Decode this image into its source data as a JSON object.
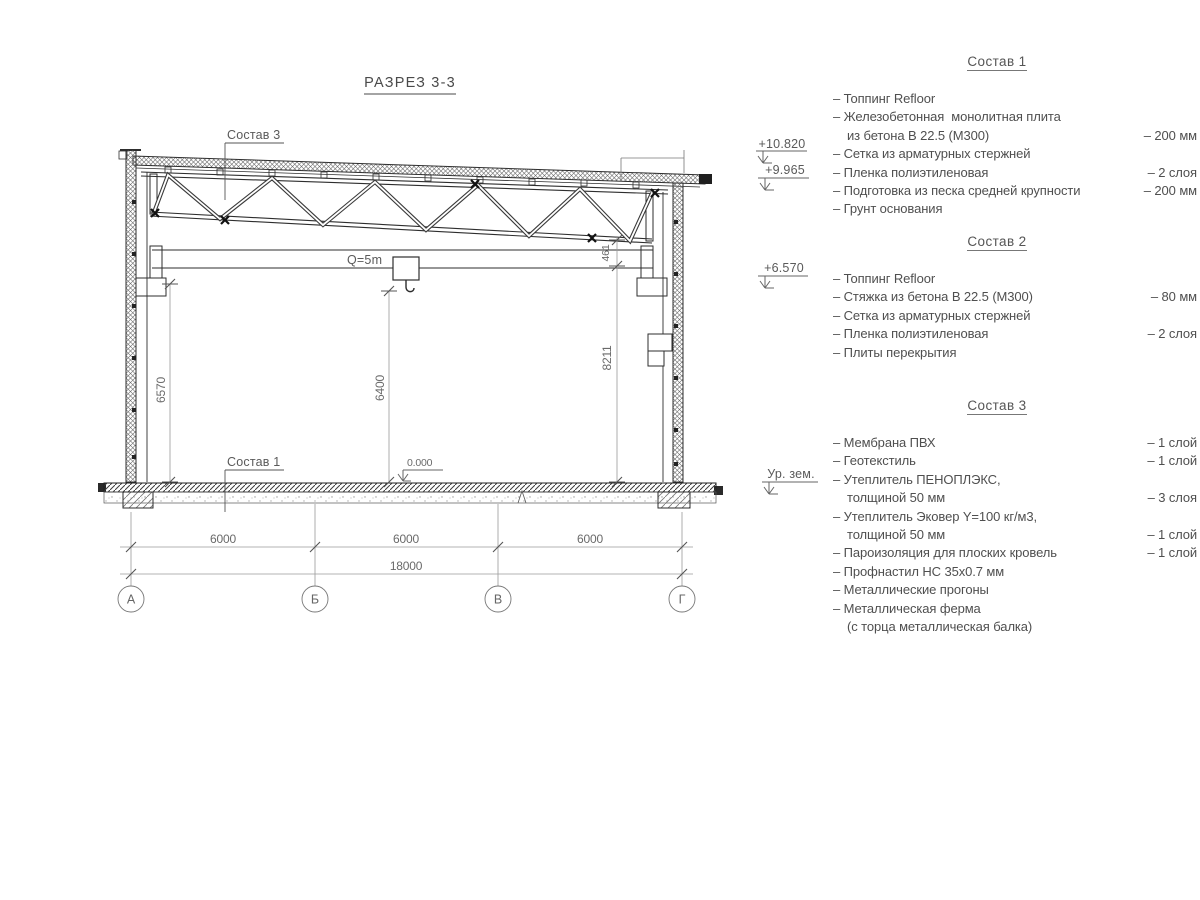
{
  "title": "РАЗРЕЗ 3-3",
  "drawing": {
    "callouts": {
      "roof": "Состав 3",
      "floor": "Состав 1"
    },
    "crane_label": "Q=5m",
    "zero_level": "0.000",
    "dims": {
      "left_height": "6570",
      "hook_height": "6400",
      "right_clear": "8211",
      "truss_offset": "461",
      "span1": "6000",
      "span2": "6000",
      "span3": "6000",
      "total": "18000"
    },
    "axes": [
      "А",
      "Б",
      "В",
      "Г"
    ],
    "elevations": {
      "roof_high": "+10.820",
      "roof_low": "+9.965",
      "crane": "+6.570",
      "ground": "Ур. зем."
    }
  },
  "lists": [
    {
      "heading": "Состав 1",
      "items": [
        {
          "text": "– Топпинг Refloor",
          "value": "",
          "indent": false
        },
        {
          "text": "– Железобетонная  монолитная плита",
          "value": "",
          "indent": false
        },
        {
          "text": "из бетона В 22.5 (М300)",
          "value": "– 200 мм",
          "indent": true
        },
        {
          "text": "– Сетка из арматурных стержней",
          "value": "",
          "indent": false
        },
        {
          "text": "– Пленка полиэтиленовая",
          "value": "– 2 слоя",
          "indent": false
        },
        {
          "text": "– Подготовка из песка средней крупности",
          "value": "– 200 мм",
          "indent": false
        },
        {
          "text": "– Грунт основания",
          "value": "",
          "indent": false
        }
      ]
    },
    {
      "heading": "Состав 2",
      "items": [
        {
          "text": "– Топпинг Refloor",
          "value": "",
          "indent": false
        },
        {
          "text": "– Стяжка из бетона В 22.5 (М300)",
          "value": "– 80 мм",
          "indent": false
        },
        {
          "text": "– Сетка из арматурных стержней",
          "value": "",
          "indent": false
        },
        {
          "text": "– Пленка полиэтиленовая",
          "value": "– 2 слоя",
          "indent": false
        },
        {
          "text": "– Плиты перекрытия",
          "value": "",
          "indent": false
        }
      ]
    },
    {
      "heading": "Состав 3",
      "items": [
        {
          "text": "– Мембрана ПВХ",
          "value": "– 1 слой",
          "indent": false
        },
        {
          "text": "– Геотекстиль",
          "value": "– 1 слой",
          "indent": false
        },
        {
          "text": "– Утеплитель ПЕНОПЛЭКС,",
          "value": "",
          "indent": false
        },
        {
          "text": "толщиной 50 мм",
          "value": "– 3 слоя",
          "indent": true
        },
        {
          "text": "– Утеплитель Эковер Y=100 кг/м3,",
          "value": "",
          "indent": false
        },
        {
          "text": "толщиной 50 мм",
          "value": "– 1 слой",
          "indent": true
        },
        {
          "text": "– Пароизоляция для плоских кровель",
          "value": "– 1 слой",
          "indent": false
        },
        {
          "text": "– Профнастил НС 35х0.7 мм",
          "value": "",
          "indent": false
        },
        {
          "text": "– Металлические прогоны",
          "value": "",
          "indent": false
        },
        {
          "text": "– Металлическая ферма",
          "value": "",
          "indent": false
        },
        {
          "text": "(с торца металлическая балка)",
          "value": "",
          "indent": true
        }
      ]
    }
  ]
}
